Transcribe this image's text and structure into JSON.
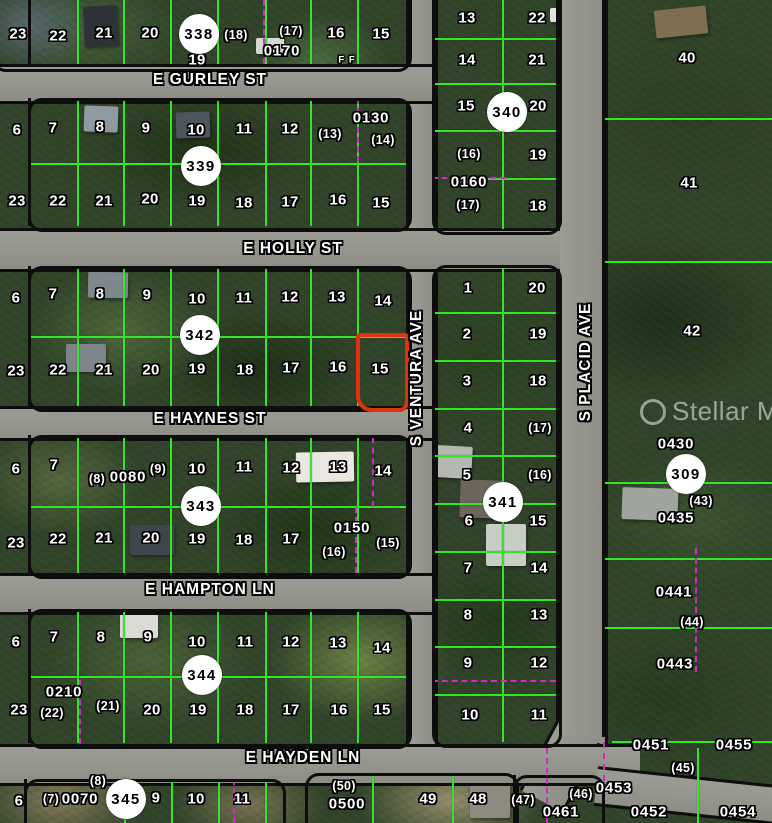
{
  "watermark": {
    "text": "Stellar MLS",
    "logo": "circle-swirl-icon"
  },
  "colors": {
    "highlight_red": "#e1310f",
    "lot_line_green": "#36e42c",
    "dashed_magenta": "#d428c8",
    "road_gray": "#95968d"
  },
  "streets": [
    {
      "name": "E GURLEY ST",
      "x": 210,
      "y": 80,
      "orient": "h"
    },
    {
      "name": "E HOLLY ST",
      "x": 293,
      "y": 249,
      "orient": "h"
    },
    {
      "name": "E HAYNES ST",
      "x": 210,
      "y": 419,
      "orient": "h"
    },
    {
      "name": "E HAMPTON LN",
      "x": 210,
      "y": 590,
      "orient": "h"
    },
    {
      "name": "E HAYDEN LN",
      "x": 303,
      "y": 758,
      "orient": "h"
    },
    {
      "name": "S VENTURA AVE",
      "x": 417,
      "y": 378,
      "orient": "v"
    },
    {
      "name": "S PLACID AVE",
      "x": 586,
      "y": 362,
      "orient": "v"
    }
  ],
  "circles": [
    {
      "t": "338",
      "x": 199,
      "y": 34
    },
    {
      "t": "339",
      "x": 201,
      "y": 166
    },
    {
      "t": "340",
      "x": 507,
      "y": 112
    },
    {
      "t": "342",
      "x": 200,
      "y": 335
    },
    {
      "t": "341",
      "x": 503,
      "y": 502
    },
    {
      "t": "343",
      "x": 201,
      "y": 506
    },
    {
      "t": "344",
      "x": 202,
      "y": 675
    },
    {
      "t": "345",
      "x": 126,
      "y": 799
    },
    {
      "t": "309",
      "x": 686,
      "y": 474
    }
  ],
  "red_parcel": {
    "lot": "15",
    "x": 356,
    "y": 333,
    "w": 45,
    "h": 71
  },
  "blocks": [
    {
      "name": "block-338",
      "x": -8,
      "y": -20,
      "w": 414,
      "h": 86
    },
    {
      "name": "block-339",
      "x": 28,
      "y": 98,
      "w": 378,
      "h": 128
    },
    {
      "name": "block-342",
      "x": 28,
      "y": 266,
      "w": 378,
      "h": 140
    },
    {
      "name": "block-343",
      "x": 28,
      "y": 435,
      "w": 378,
      "h": 138
    },
    {
      "name": "block-344",
      "x": 28,
      "y": 609,
      "w": 378,
      "h": 134
    },
    {
      "name": "block-345",
      "x": 24,
      "y": 779,
      "w": 256,
      "h": 58
    },
    {
      "name": "block-340",
      "x": 432,
      "y": -20,
      "w": 124,
      "h": 249
    },
    {
      "name": "block-341",
      "x": 432,
      "y": 265,
      "w": 124,
      "h": 477
    },
    {
      "name": "block-south-1",
      "x": 305,
      "y": 773,
      "w": 208,
      "h": 64
    },
    {
      "name": "block-south-2",
      "x": 513,
      "y": 775,
      "w": 86,
      "h": 62
    }
  ],
  "labels": [
    {
      "t": "23",
      "x": 18,
      "y": 34
    },
    {
      "t": "22",
      "x": 58,
      "y": 36
    },
    {
      "t": "21",
      "x": 104,
      "y": 33
    },
    {
      "t": "20",
      "x": 150,
      "y": 33
    },
    {
      "t": "19",
      "x": 197,
      "y": 60
    },
    {
      "t": "(18)",
      "x": 236,
      "y": 35,
      "k": "lotp"
    },
    {
      "t": "(17)",
      "x": 291,
      "y": 31,
      "k": "lotp"
    },
    {
      "t": "0170",
      "x": 282,
      "y": 51,
      "k": "pid"
    },
    {
      "t": "16",
      "x": 336,
      "y": 33
    },
    {
      "t": "15",
      "x": 381,
      "y": 34
    },
    {
      "t": "F F",
      "x": 347,
      "y": 60,
      "k": "small"
    },
    {
      "t": "6",
      "x": 17,
      "y": 130
    },
    {
      "t": "7",
      "x": 53,
      "y": 128
    },
    {
      "t": "8",
      "x": 100,
      "y": 127
    },
    {
      "t": "9",
      "x": 146,
      "y": 128
    },
    {
      "t": "10",
      "x": 196,
      "y": 130
    },
    {
      "t": "11",
      "x": 244,
      "y": 129
    },
    {
      "t": "12",
      "x": 290,
      "y": 129
    },
    {
      "t": "(13)",
      "x": 330,
      "y": 134,
      "k": "lotp"
    },
    {
      "t": "0130",
      "x": 371,
      "y": 118,
      "k": "pid"
    },
    {
      "t": "(14)",
      "x": 383,
      "y": 140,
      "k": "lotp"
    },
    {
      "t": "23",
      "x": 17,
      "y": 201
    },
    {
      "t": "22",
      "x": 58,
      "y": 201
    },
    {
      "t": "21",
      "x": 104,
      "y": 201
    },
    {
      "t": "20",
      "x": 150,
      "y": 199
    },
    {
      "t": "19",
      "x": 197,
      "y": 201
    },
    {
      "t": "18",
      "x": 244,
      "y": 203
    },
    {
      "t": "17",
      "x": 290,
      "y": 202
    },
    {
      "t": "16",
      "x": 338,
      "y": 200
    },
    {
      "t": "15",
      "x": 381,
      "y": 203
    },
    {
      "t": "13",
      "x": 467,
      "y": 18
    },
    {
      "t": "22",
      "x": 537,
      "y": 18
    },
    {
      "t": "14",
      "x": 467,
      "y": 60
    },
    {
      "t": "21",
      "x": 537,
      "y": 60
    },
    {
      "t": "15",
      "x": 466,
      "y": 106
    },
    {
      "t": "20",
      "x": 538,
      "y": 106
    },
    {
      "t": "(16)",
      "x": 469,
      "y": 154,
      "k": "lotp"
    },
    {
      "t": "19",
      "x": 538,
      "y": 155
    },
    {
      "t": "0160",
      "x": 469,
      "y": 182,
      "k": "pid"
    },
    {
      "t": "(17)",
      "x": 468,
      "y": 205,
      "k": "lotp"
    },
    {
      "t": "18",
      "x": 538,
      "y": 206
    },
    {
      "t": "40",
      "x": 687,
      "y": 58
    },
    {
      "t": "41",
      "x": 689,
      "y": 183
    },
    {
      "t": "42",
      "x": 692,
      "y": 331
    },
    {
      "t": "6",
      "x": 16,
      "y": 298
    },
    {
      "t": "7",
      "x": 53,
      "y": 294
    },
    {
      "t": "8",
      "x": 100,
      "y": 294
    },
    {
      "t": "9",
      "x": 147,
      "y": 295
    },
    {
      "t": "10",
      "x": 197,
      "y": 299
    },
    {
      "t": "11",
      "x": 244,
      "y": 298
    },
    {
      "t": "12",
      "x": 290,
      "y": 297
    },
    {
      "t": "13",
      "x": 337,
      "y": 297
    },
    {
      "t": "14",
      "x": 383,
      "y": 301
    },
    {
      "t": "23",
      "x": 16,
      "y": 371
    },
    {
      "t": "22",
      "x": 58,
      "y": 370
    },
    {
      "t": "21",
      "x": 104,
      "y": 370
    },
    {
      "t": "20",
      "x": 151,
      "y": 370
    },
    {
      "t": "19",
      "x": 197,
      "y": 369
    },
    {
      "t": "18",
      "x": 245,
      "y": 370
    },
    {
      "t": "17",
      "x": 291,
      "y": 368
    },
    {
      "t": "16",
      "x": 338,
      "y": 367
    },
    {
      "t": "15",
      "x": 380,
      "y": 369
    },
    {
      "t": "1",
      "x": 468,
      "y": 288
    },
    {
      "t": "20",
      "x": 537,
      "y": 288
    },
    {
      "t": "2",
      "x": 467,
      "y": 334
    },
    {
      "t": "19",
      "x": 538,
      "y": 334
    },
    {
      "t": "3",
      "x": 467,
      "y": 381
    },
    {
      "t": "18",
      "x": 538,
      "y": 381
    },
    {
      "t": "4",
      "x": 468,
      "y": 428
    },
    {
      "t": "(17)",
      "x": 540,
      "y": 428,
      "k": "lotp"
    },
    {
      "t": "5",
      "x": 467,
      "y": 475
    },
    {
      "t": "(16)",
      "x": 540,
      "y": 475,
      "k": "lotp"
    },
    {
      "t": "6",
      "x": 469,
      "y": 521
    },
    {
      "t": "15",
      "x": 538,
      "y": 521
    },
    {
      "t": "7",
      "x": 468,
      "y": 568
    },
    {
      "t": "14",
      "x": 539,
      "y": 568
    },
    {
      "t": "8",
      "x": 468,
      "y": 615
    },
    {
      "t": "13",
      "x": 539,
      "y": 615
    },
    {
      "t": "9",
      "x": 468,
      "y": 663
    },
    {
      "t": "12",
      "x": 539,
      "y": 663
    },
    {
      "t": "10",
      "x": 470,
      "y": 715
    },
    {
      "t": "11",
      "x": 539,
      "y": 715
    },
    {
      "t": "0430",
      "x": 676,
      "y": 444,
      "k": "pid"
    },
    {
      "t": "(43)",
      "x": 701,
      "y": 501,
      "k": "lotp"
    },
    {
      "t": "0435",
      "x": 676,
      "y": 518,
      "k": "pid"
    },
    {
      "t": "0441",
      "x": 674,
      "y": 592,
      "k": "pid"
    },
    {
      "t": "(44)",
      "x": 692,
      "y": 622,
      "k": "lotp"
    },
    {
      "t": "0443",
      "x": 675,
      "y": 664,
      "k": "pid"
    },
    {
      "t": "6",
      "x": 16,
      "y": 469
    },
    {
      "t": "7",
      "x": 54,
      "y": 465
    },
    {
      "t": "(8)",
      "x": 97,
      "y": 479,
      "k": "lotp"
    },
    {
      "t": "0080",
      "x": 128,
      "y": 477,
      "k": "pid"
    },
    {
      "t": "(9)",
      "x": 158,
      "y": 469,
      "k": "lotp"
    },
    {
      "t": "10",
      "x": 197,
      "y": 469
    },
    {
      "t": "11",
      "x": 244,
      "y": 467
    },
    {
      "t": "12",
      "x": 291,
      "y": 468
    },
    {
      "t": "13",
      "x": 338,
      "y": 467
    },
    {
      "t": "14",
      "x": 383,
      "y": 471
    },
    {
      "t": "23",
      "x": 16,
      "y": 543
    },
    {
      "t": "22",
      "x": 58,
      "y": 539
    },
    {
      "t": "21",
      "x": 104,
      "y": 538
    },
    {
      "t": "20",
      "x": 151,
      "y": 538
    },
    {
      "t": "19",
      "x": 197,
      "y": 539
    },
    {
      "t": "18",
      "x": 244,
      "y": 540
    },
    {
      "t": "17",
      "x": 291,
      "y": 539
    },
    {
      "t": "0150",
      "x": 352,
      "y": 528,
      "k": "pid"
    },
    {
      "t": "(16)",
      "x": 334,
      "y": 552,
      "k": "lotp"
    },
    {
      "t": "(15)",
      "x": 388,
      "y": 543,
      "k": "lotp"
    },
    {
      "t": "6",
      "x": 16,
      "y": 642
    },
    {
      "t": "7",
      "x": 54,
      "y": 637
    },
    {
      "t": "8",
      "x": 101,
      "y": 637
    },
    {
      "t": "9",
      "x": 148,
      "y": 637
    },
    {
      "t": "10",
      "x": 197,
      "y": 642
    },
    {
      "t": "11",
      "x": 245,
      "y": 642
    },
    {
      "t": "12",
      "x": 291,
      "y": 642
    },
    {
      "t": "13",
      "x": 338,
      "y": 643
    },
    {
      "t": "14",
      "x": 382,
      "y": 648
    },
    {
      "t": "23",
      "x": 19,
      "y": 710
    },
    {
      "t": "0210",
      "x": 64,
      "y": 692,
      "k": "pid"
    },
    {
      "t": "(22)",
      "x": 52,
      "y": 713,
      "k": "lotp"
    },
    {
      "t": "(21)",
      "x": 108,
      "y": 706,
      "k": "lotp"
    },
    {
      "t": "20",
      "x": 152,
      "y": 710
    },
    {
      "t": "19",
      "x": 198,
      "y": 710
    },
    {
      "t": "18",
      "x": 245,
      "y": 710
    },
    {
      "t": "17",
      "x": 291,
      "y": 710
    },
    {
      "t": "16",
      "x": 339,
      "y": 710
    },
    {
      "t": "15",
      "x": 382,
      "y": 710
    },
    {
      "t": "6",
      "x": 19,
      "y": 801
    },
    {
      "t": "(7)",
      "x": 51,
      "y": 799,
      "k": "lotp"
    },
    {
      "t": "0070",
      "x": 80,
      "y": 799,
      "k": "pid"
    },
    {
      "t": "(8)",
      "x": 98,
      "y": 781,
      "k": "lotp"
    },
    {
      "t": "9",
      "x": 156,
      "y": 798
    },
    {
      "t": "10",
      "x": 196,
      "y": 799
    },
    {
      "t": "11",
      "x": 242,
      "y": 799
    },
    {
      "t": "(50)",
      "x": 344,
      "y": 786,
      "k": "lotp"
    },
    {
      "t": "0500",
      "x": 347,
      "y": 804,
      "k": "pid"
    },
    {
      "t": "49",
      "x": 428,
      "y": 799
    },
    {
      "t": "48",
      "x": 478,
      "y": 799
    },
    {
      "t": "(47)",
      "x": 523,
      "y": 800,
      "k": "lotp"
    },
    {
      "t": "(46)",
      "x": 581,
      "y": 794,
      "k": "lotp"
    },
    {
      "t": "0461",
      "x": 561,
      "y": 812,
      "k": "pid"
    },
    {
      "t": "0453",
      "x": 614,
      "y": 788,
      "k": "pid"
    },
    {
      "t": "0451",
      "x": 651,
      "y": 745,
      "k": "pid"
    },
    {
      "t": "0455",
      "x": 734,
      "y": 745,
      "k": "pid"
    },
    {
      "t": "(45)",
      "x": 683,
      "y": 768,
      "k": "lotp"
    },
    {
      "t": "0452",
      "x": 649,
      "y": 812,
      "k": "pid"
    },
    {
      "t": "0454",
      "x": 738,
      "y": 812,
      "k": "pid"
    }
  ],
  "lines": {
    "green": [
      [
        77,
        0,
        2,
        64
      ],
      [
        123,
        0,
        2,
        64
      ],
      [
        170,
        0,
        2,
        64
      ],
      [
        217,
        0,
        2,
        64
      ],
      [
        265,
        0,
        2,
        64
      ],
      [
        310,
        0,
        2,
        64
      ],
      [
        357,
        0,
        2,
        64
      ],
      [
        77,
        98,
        2,
        128
      ],
      [
        123,
        98,
        2,
        128
      ],
      [
        170,
        98,
        2,
        128
      ],
      [
        217,
        98,
        2,
        128
      ],
      [
        265,
        98,
        2,
        128
      ],
      [
        310,
        98,
        2,
        128
      ],
      [
        357,
        98,
        2,
        128
      ],
      [
        77,
        266,
        2,
        140
      ],
      [
        123,
        266,
        2,
        140
      ],
      [
        170,
        266,
        2,
        140
      ],
      [
        217,
        266,
        2,
        140
      ],
      [
        265,
        266,
        2,
        140
      ],
      [
        310,
        266,
        2,
        140
      ],
      [
        357,
        266,
        2,
        140
      ],
      [
        77,
        435,
        2,
        138
      ],
      [
        123,
        435,
        2,
        138
      ],
      [
        170,
        435,
        2,
        138
      ],
      [
        217,
        435,
        2,
        138
      ],
      [
        265,
        435,
        2,
        138
      ],
      [
        310,
        435,
        2,
        138
      ],
      [
        357,
        435,
        2,
        138
      ],
      [
        77,
        609,
        2,
        134
      ],
      [
        123,
        609,
        2,
        134
      ],
      [
        170,
        609,
        2,
        134
      ],
      [
        217,
        609,
        2,
        134
      ],
      [
        265,
        609,
        2,
        134
      ],
      [
        310,
        609,
        2,
        134
      ],
      [
        357,
        609,
        2,
        134
      ],
      [
        124,
        779,
        2,
        44
      ],
      [
        171,
        779,
        2,
        44
      ],
      [
        218,
        779,
        2,
        44
      ],
      [
        265,
        779,
        2,
        44
      ],
      [
        29,
        163,
        377,
        2
      ],
      [
        29,
        336,
        377,
        2
      ],
      [
        29,
        506,
        377,
        2
      ],
      [
        29,
        676,
        377,
        2
      ],
      [
        502,
        0,
        2,
        229
      ],
      [
        432,
        38,
        124,
        2
      ],
      [
        432,
        83,
        124,
        2
      ],
      [
        432,
        130,
        124,
        2
      ],
      [
        488,
        178,
        68,
        2
      ],
      [
        502,
        265,
        2,
        477
      ],
      [
        432,
        312,
        124,
        2
      ],
      [
        432,
        360,
        124,
        2
      ],
      [
        432,
        408,
        124,
        2
      ],
      [
        432,
        455,
        124,
        2
      ],
      [
        432,
        503,
        124,
        2
      ],
      [
        432,
        551,
        124,
        2
      ],
      [
        432,
        599,
        124,
        2
      ],
      [
        432,
        646,
        124,
        2
      ],
      [
        432,
        694,
        124,
        2
      ],
      [
        372,
        773,
        2,
        50
      ],
      [
        452,
        773,
        2,
        50
      ],
      [
        602,
        118,
        170,
        2
      ],
      [
        602,
        261,
        170,
        2
      ],
      [
        602,
        482,
        170,
        2
      ],
      [
        602,
        558,
        170,
        2
      ],
      [
        602,
        627,
        170,
        2
      ],
      [
        612,
        741,
        160,
        2
      ],
      [
        697,
        748,
        2,
        75
      ]
    ],
    "magenta": [
      [
        263,
        0,
        2,
        64
      ],
      [
        357,
        98,
        2,
        64
      ],
      [
        432,
        177,
        74,
        2
      ],
      [
        372,
        437,
        2,
        70
      ],
      [
        355,
        507,
        2,
        66
      ],
      [
        79,
        680,
        2,
        64
      ],
      [
        233,
        779,
        2,
        44
      ],
      [
        546,
        748,
        2,
        75
      ],
      [
        695,
        548,
        2,
        124
      ],
      [
        603,
        742,
        2,
        50
      ],
      [
        432,
        680,
        124,
        2
      ]
    ],
    "black": [
      [
        28,
        0,
        3,
        64
      ],
      [
        28,
        98,
        3,
        128
      ],
      [
        28,
        266,
        3,
        140
      ],
      [
        28,
        435,
        3,
        138
      ],
      [
        28,
        609,
        3,
        134
      ],
      [
        24,
        779,
        3,
        44
      ],
      [
        602,
        0,
        3,
        737
      ],
      [
        513,
        775,
        3,
        48
      ]
    ]
  }
}
